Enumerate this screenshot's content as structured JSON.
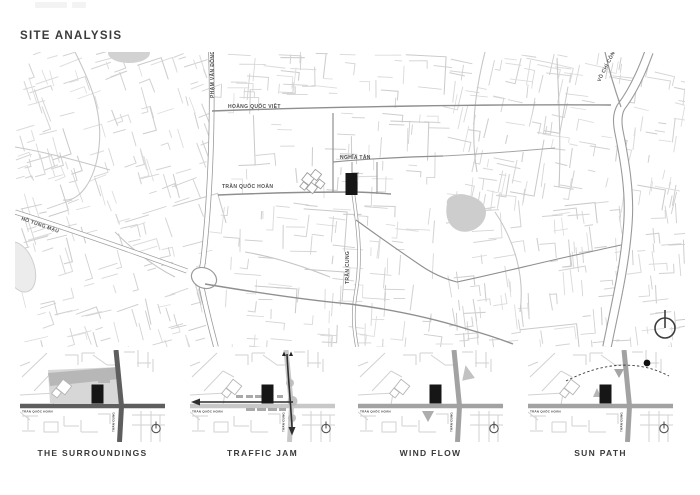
{
  "title": "SITE ANALYSIS",
  "main_map": {
    "street_labels": {
      "pham_van_dong": "PHẠM VĂN ĐỒNG",
      "hoang_quoc_viet": "HOÀNG QUỐC VIỆT",
      "vo_chi_cong": "VÕ CHÍ CÔNG",
      "nghia_tan": "NGHĨA TÂN",
      "tran_quoc_hoan": "TRẦN QUỐC HOÀN",
      "tran_cung": "TRẦN CUNG",
      "ho_tung_mau": "HỒ TÙNG MẬU"
    },
    "icons": {
      "north_indicator": "north-arrow-circle"
    }
  },
  "mini_maps": {
    "street_labels": {
      "tran_quoc_hoan": "TRẦN QUỐC HOÀN",
      "tran_cung": "TRẦN CUNG"
    },
    "panels": [
      {
        "id": "surroundings",
        "label": "THE SURROUNDINGS"
      },
      {
        "id": "traffic-jam",
        "label": "TRAFFIC JAM"
      },
      {
        "id": "wind-flow",
        "label": "WIND FLOW"
      },
      {
        "id": "sun-path",
        "label": "SUN PATH"
      }
    ]
  },
  "colors": {
    "site_building": "#161616",
    "minor_street": "#d6d6d6",
    "major_street": "#9a9a9a",
    "water": "#cdcdcd",
    "arrow_dark": "#2e2e2e"
  }
}
